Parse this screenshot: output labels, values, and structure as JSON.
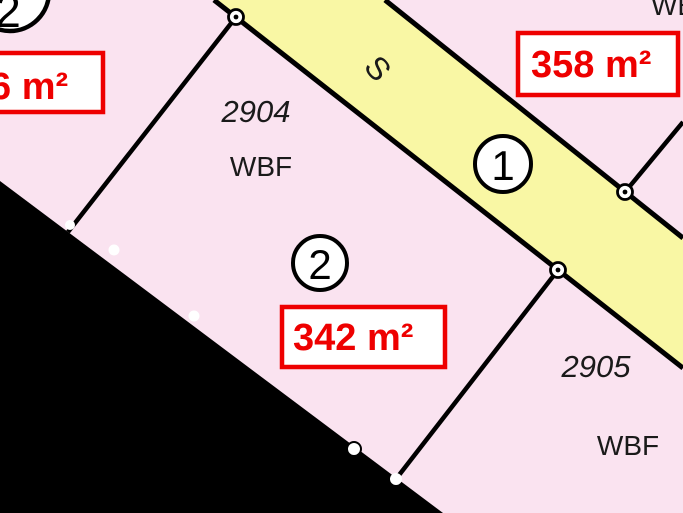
{
  "title": "Cadastral survey plan extract",
  "colors": {
    "parcel_pink": "#fae3f0",
    "road_yellow": "#f9f7a4",
    "outline_black": "#000000",
    "area_red": "#ee0000",
    "marker_white": "#ffffff"
  },
  "road": {
    "street_letter": "S",
    "lot_number_circled": "1"
  },
  "lots": {
    "top_left": {
      "circled": "2",
      "area": "6 m²"
    },
    "l2904": {
      "number": "2904",
      "usage": "WBF"
    },
    "center": {
      "circled": "2",
      "area": "342 m²"
    },
    "top_right": {
      "usage": "WBF",
      "area": "358 m²"
    },
    "l2905": {
      "number": "2905",
      "usage": "WBF"
    }
  }
}
